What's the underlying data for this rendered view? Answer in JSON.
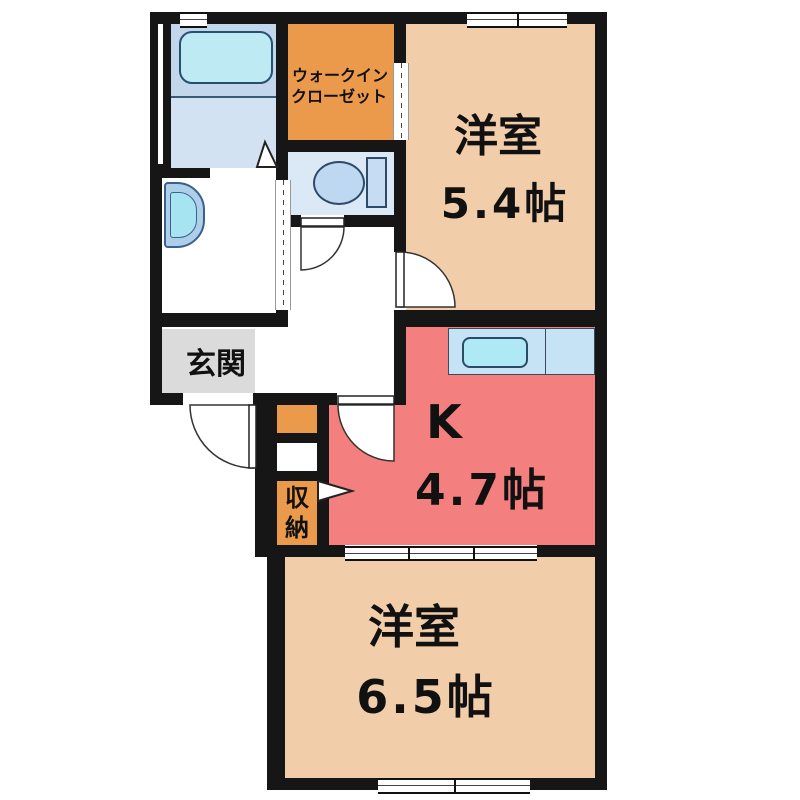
{
  "plan": {
    "type": "apartment-floorplan",
    "rooms": {
      "western_room_1": {
        "name": "洋室",
        "size": "5.4帖"
      },
      "kitchen": {
        "name": "K",
        "size": "4.7帖"
      },
      "western_room_2": {
        "name": "洋室",
        "size": "6.5帖"
      },
      "walk_in_closet": {
        "line1": "ウォークイン",
        "line2": "クローゼット"
      },
      "entrance": {
        "name": "玄関"
      },
      "storage": {
        "name": "収納"
      }
    },
    "colors": {
      "wall": "#161616",
      "room_peach": "#F2CDA9",
      "kitchen_salmon": "#F37F7F",
      "closet_orange": "#EB9A4C",
      "entrance_gray": "#DBDBDB",
      "bathroom_blue": "#C3D7EC",
      "toilet_blue": "#DBE9F7",
      "counter_blue": "#C6E2F5",
      "sink_cyan": "#ADEAF5"
    },
    "fixtures": [
      "bathtub",
      "toilet",
      "washbasin",
      "kitchen-sink"
    ]
  }
}
